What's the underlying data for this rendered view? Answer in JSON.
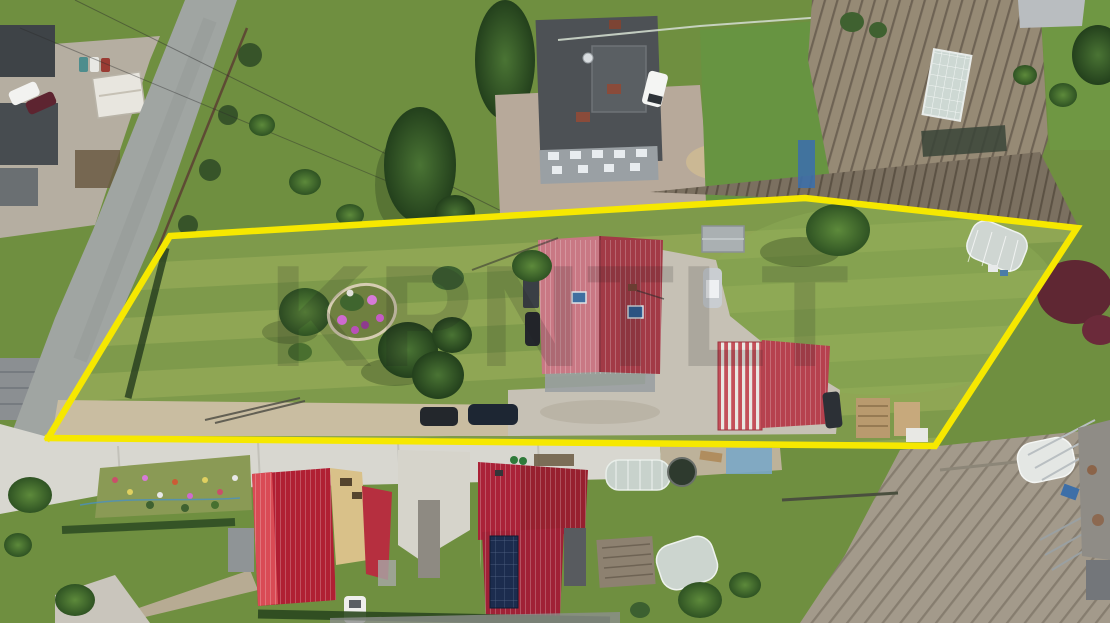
{
  "image": {
    "kind": "aerial drone photograph of a residential building plot for sale",
    "width_px": 1110,
    "height_px": 623
  },
  "watermark": {
    "text": "KPNTLT",
    "opacity": 0.16,
    "color": "#1f1f1f"
  },
  "boundary": {
    "points": "48,438 170,236 805,198 1077,228 935,446 48,438",
    "color": "#f6e800",
    "stroke_width": 6.5,
    "shape": "five-vertex polygon outlining the listed plot"
  },
  "colors": {
    "boundary_yellow": "#f6e800",
    "main_house_roof_light": "#c97884",
    "main_house_roof_dark": "#a23a46",
    "outbuilding_roof": "#b6414e",
    "bottom_left_house_roof": "#c2273a",
    "bottom_center_house_roof": "#a02136",
    "big_house_flat_roof": "#4d5155",
    "asphalt_road": "#a0a5a2",
    "concrete_lane": "#d8d7d0",
    "lawn_green": "#7e9a4b",
    "field_soil": "#a39a8b",
    "solar_panels": "#1c2c4e",
    "greenhouse_white": "#cfd6d2",
    "purple_leaf_tree": "#5f2733",
    "flower_pink": "#cf6ad0"
  },
  "scene": {
    "plot_features": [
      "mowed lawn with stripes",
      "flower island with pink blooms",
      "conifer group",
      "red gable-roof house with two skylights and antenna",
      "small gray shed",
      "silver car",
      "dark cars by the lane",
      "red outbuilding with striped roof section",
      "white polytunnel greenhouse",
      "firewood stacks",
      "concrete yard",
      "hedge along street side"
    ],
    "north_side": [
      "asphalt road junction",
      "neighbor yard with white shed and two cars",
      "large dark flat-roof villa with brick chimneys",
      "white van",
      "firewood pile",
      "vegetable garden with glass greenhouse",
      "tree line",
      "power cables"
    ],
    "south_side": [
      "white concrete lane",
      "rockery flower garden",
      "tan house with bright red roof",
      "crimson-roof house with rooftop solar array",
      "polytunnels",
      "trampoline",
      "plowed field with crop rows",
      "purple-leaf tree",
      "white storage tunnel",
      "farm sheds"
    ]
  }
}
